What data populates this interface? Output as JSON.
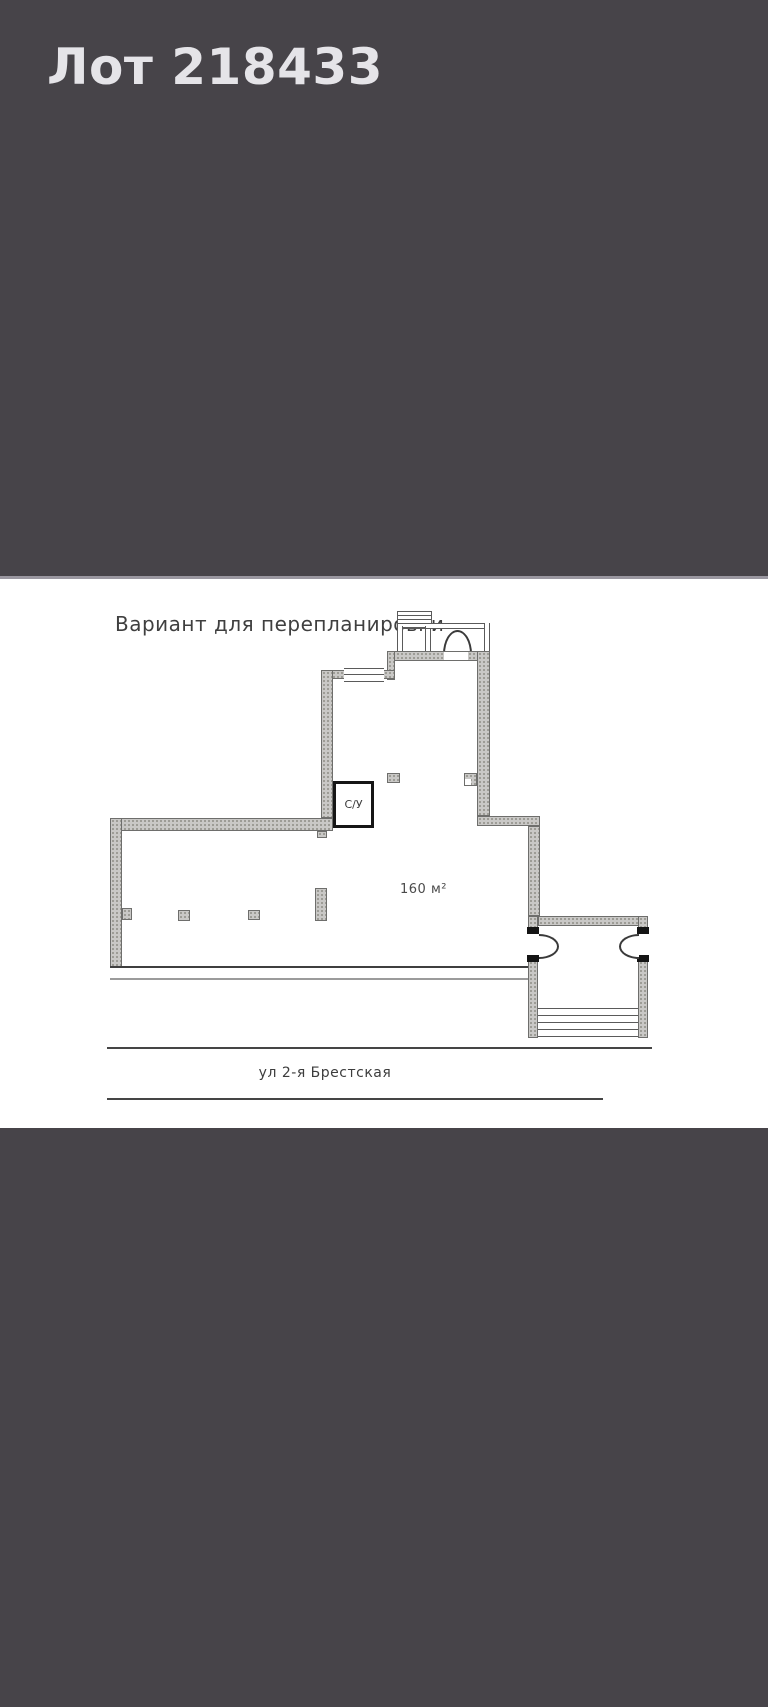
{
  "header": {
    "lot_title": "Лот 218433"
  },
  "floor_plan": {
    "caption": "Вариант для перепланировки",
    "bathroom_label": "С/У",
    "area_label": "160 м²",
    "street_label": "ул 2-я Брестская"
  },
  "colors": {
    "page_background": "#474449",
    "header_text": "#e5e4e8",
    "plan_background": "#ffffff",
    "wall_fill": "#c9c8c6",
    "wall_outline": "#6e6e6c",
    "bathroom_wall": "#161616",
    "line_color": "#454545"
  }
}
